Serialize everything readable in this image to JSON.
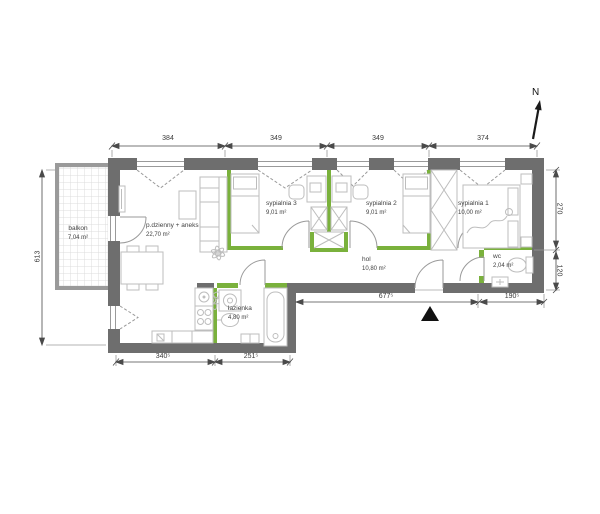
{
  "plan": {
    "north_label": "N",
    "rooms": [
      {
        "name": "balkon",
        "area": "7,04 m²"
      },
      {
        "name": "p.dzienny + aneks",
        "area": "22,70 m²"
      },
      {
        "name": "sypialnia 3",
        "area": "9,01 m²"
      },
      {
        "name": "sypialnia 2",
        "area": "9,01 m²"
      },
      {
        "name": "sypialnia 1",
        "area": "10,00 m²"
      },
      {
        "name": "hol",
        "area": "10,80 m²"
      },
      {
        "name": "wc",
        "area": "2,04 m²"
      },
      {
        "name": "łazienka",
        "area": "4,80 m²"
      }
    ],
    "dimensions": {
      "top": [
        "384",
        "349",
        "349",
        "374"
      ],
      "left": "613",
      "right": [
        "270",
        "120"
      ],
      "bottom_inner": [
        "677⁵",
        "190⁵"
      ],
      "bottom_left": [
        "340⁵",
        "251⁵"
      ]
    },
    "colors": {
      "wall": "#6e6e6e",
      "partition": "#7ab13c",
      "balcony": "#9a9a9a",
      "furniture": "#bdbdbd",
      "dimension": "#3a3a3a"
    }
  }
}
